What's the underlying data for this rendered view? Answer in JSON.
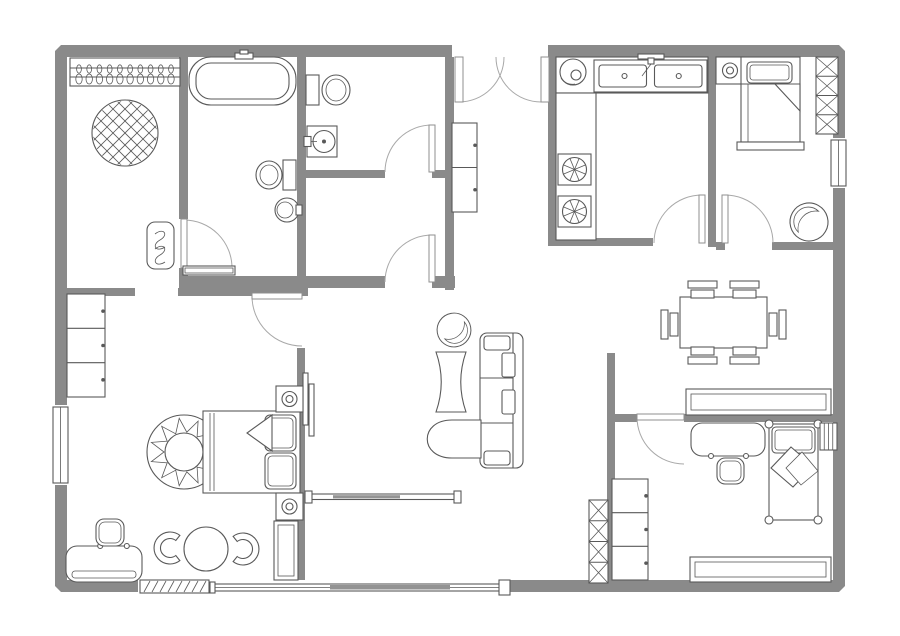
{
  "title": "floor-plan",
  "canvas": {
    "w": 900,
    "h": 636,
    "bg": "#ffffff"
  },
  "palette": {
    "wall": "#8a8a8a",
    "line": "#595959",
    "door_arc": "#a8a8a8"
  },
  "outer_wall": {
    "x": 55,
    "y": 45,
    "w": 790,
    "h": 547,
    "t": 12
  },
  "wall_openings": [
    [
      452,
      44,
      96,
      14
    ],
    [
      830,
      138,
      17,
      50
    ],
    [
      52,
      405,
      17,
      80
    ],
    [
      138,
      578,
      73,
      16
    ],
    [
      210,
      578,
      298,
      16
    ]
  ],
  "walls": [
    [
      179,
      57,
      9,
      162
    ],
    [
      179,
      268,
      9,
      20
    ],
    [
      297,
      57,
      9,
      219
    ],
    [
      445,
      57,
      9,
      233
    ],
    [
      306,
      170,
      79,
      8
    ],
    [
      432,
      170,
      13,
      8
    ],
    [
      179,
      276,
      206,
      12
    ],
    [
      432,
      276,
      23,
      12
    ],
    [
      60,
      288,
      75,
      8
    ],
    [
      178,
      288,
      130,
      8
    ],
    [
      297,
      348,
      8,
      232
    ],
    [
      548,
      57,
      8,
      189
    ],
    [
      548,
      238,
      105,
      8
    ],
    [
      708,
      57,
      8,
      190
    ],
    [
      716,
      242,
      9,
      8
    ],
    [
      772,
      242,
      61,
      8
    ],
    [
      607,
      353,
      8,
      227
    ],
    [
      610,
      414,
      27,
      8
    ],
    [
      684,
      414,
      149,
      8
    ]
  ],
  "windows": [
    {
      "name": "window-bedroom-right",
      "type": "win",
      "x": 831,
      "y": 140,
      "w": 15,
      "h": 46
    },
    {
      "name": "window-bedroom-left",
      "type": "win",
      "x": 53,
      "y": 407,
      "w": 15,
      "h": 76
    },
    {
      "name": "window-louver-bottom",
      "type": "win_hatch",
      "x": 140,
      "y": 580,
      "w": 69,
      "h": 13
    },
    {
      "name": "sliding-patio-door",
      "type": "slider",
      "x1": 212,
      "x2": 506
    },
    {
      "name": "sliding-room-divider",
      "type": "slider2",
      "x1": 308,
      "x2": 457
    }
  ],
  "doors": [
    {
      "name": "entry-double-door",
      "leaves": [
        [
          455,
          57,
          8,
          45
        ],
        [
          541,
          57,
          8,
          45
        ]
      ],
      "arcs": [
        "M459,102 A45,45 0 0 0 504,57",
        "M541,102 A45,45 0 0 1 496,57"
      ]
    },
    {
      "name": "closet-bath-door",
      "leaves": [
        [
          181,
          219,
          6,
          49
        ]
      ],
      "arcs": [
        "M184,220 A48,48 0 0 1 232,268"
      ]
    },
    {
      "name": "bathroom2-door",
      "leaves": [
        [
          429,
          125,
          6,
          47
        ]
      ],
      "arcs": [
        "M432,125 A47,47 0 0 0 385,172"
      ]
    },
    {
      "name": "storage-room-door",
      "leaves": [
        [
          429,
          235,
          6,
          47
        ]
      ],
      "arcs": [
        "M432,235 A47,47 0 0 0 385,282"
      ]
    },
    {
      "name": "bedroom1-door",
      "leaves": [
        [
          252,
          293,
          50,
          6
        ]
      ],
      "arcs": [
        "M252,296 A50,50 0 0 0 302,346"
      ]
    },
    {
      "name": "kitchen-door",
      "leaves": [
        [
          699,
          195,
          6,
          48
        ]
      ],
      "arcs": [
        "M702,195 A48,48 0 0 0 654,243"
      ]
    },
    {
      "name": "bedroom2-door",
      "leaves": [
        [
          722,
          195,
          6,
          48
        ]
      ],
      "arcs": [
        "M725,195 A48,48 0 0 1 773,243"
      ]
    },
    {
      "name": "bedroom3-door",
      "leaves": [
        [
          637,
          414,
          47,
          6
        ]
      ],
      "arcs": [
        "M637,417 A47,47 0 0 0 684,464"
      ]
    }
  ],
  "furniture": [
    {
      "name": "closet-hanger-rail",
      "type": "hanger_rail",
      "x": 70,
      "y": 58,
      "w": 110,
      "h": 28,
      "n": 10
    },
    {
      "name": "closet-round-rug",
      "type": "rug_hatch",
      "cx": 125,
      "cy": 133,
      "r": 33
    },
    {
      "name": "closet-door-mat",
      "type": "rug_squiggle",
      "x": 147,
      "y": 222,
      "w": 27,
      "h": 47
    },
    {
      "name": "bath1-bathtub",
      "type": "bathtub",
      "x": 189,
      "y": 57,
      "w": 107,
      "h": 48
    },
    {
      "name": "bath1-toilet",
      "type": "toilet",
      "tank": [
        283,
        160,
        13,
        30
      ],
      "bowl": [
        269,
        175,
        13,
        14
      ]
    },
    {
      "name": "bath1-basin",
      "type": "sink_round",
      "cx": 287,
      "cy": 210,
      "r": 12
    },
    {
      "name": "bath1-shelf",
      "type": "shelf",
      "x": 183,
      "y": 266,
      "w": 52,
      "h": 9,
      "inset": 2
    },
    {
      "name": "bath2-toilet",
      "type": "toilet",
      "tank": [
        306,
        75,
        13,
        30
      ],
      "bowl": [
        336,
        90,
        14,
        15
      ]
    },
    {
      "name": "bath2-basin",
      "type": "sink_square",
      "x": 307,
      "y": 126,
      "w": 30,
      "h": 31
    },
    {
      "name": "hall-cabinet",
      "type": "cabinet",
      "x": 452,
      "y": 123,
      "w": 25,
      "h": 89,
      "sections": 2
    },
    {
      "name": "kitchen-counter-top",
      "type": "rect",
      "x": 556,
      "y": 57,
      "w": 152,
      "h": 36
    },
    {
      "name": "kitchen-counter-side",
      "type": "rect",
      "x": 556,
      "y": 93,
      "w": 40,
      "h": 147
    },
    {
      "name": "kitchen-double-sink",
      "type": "ksink2",
      "x": 594,
      "y": 60,
      "w": 113,
      "h": 32
    },
    {
      "name": "kitchen-round-sink",
      "type": "ksink_round",
      "cx": 573,
      "cy": 72,
      "r": 13
    },
    {
      "name": "kitchen-burner-1",
      "type": "burner",
      "x": 558,
      "y": 154,
      "w": 33,
      "h": 31
    },
    {
      "name": "kitchen-burner-2",
      "type": "burner",
      "x": 558,
      "y": 196,
      "w": 33,
      "h": 31
    },
    {
      "name": "bedroom2-nightstand",
      "type": "nightstand",
      "x": 716,
      "y": 57,
      "w": 28,
      "h": 27
    },
    {
      "name": "bedroom2-bed",
      "type": "bed_v",
      "x": 741,
      "y": 57,
      "w": 59,
      "h": 85
    },
    {
      "name": "bedroom2-closet-shelves",
      "type": "xshelf",
      "x": 816,
      "y": 57,
      "w": 22,
      "h": 77,
      "cells": 4
    },
    {
      "name": "bedroom2-armchair",
      "type": "tub_chair",
      "cx": 809,
      "cy": 222,
      "r": 19,
      "rot": -15
    },
    {
      "name": "dining-table",
      "type": "rect",
      "x": 680,
      "y": 297,
      "w": 87,
      "h": 51
    },
    {
      "name": "dining-chair-1",
      "type": "chair",
      "x": 688,
      "y": 281,
      "w": 29,
      "h": 17,
      "back": "top"
    },
    {
      "name": "dining-chair-2",
      "type": "chair",
      "x": 730,
      "y": 281,
      "w": 29,
      "h": 17,
      "back": "top"
    },
    {
      "name": "dining-chair-3",
      "type": "chair",
      "x": 688,
      "y": 347,
      "w": 29,
      "h": 17,
      "back": "bottom"
    },
    {
      "name": "dining-chair-4",
      "type": "chair",
      "x": 730,
      "y": 347,
      "w": 29,
      "h": 17,
      "back": "bottom"
    },
    {
      "name": "dining-chair-5",
      "type": "chair",
      "x": 661,
      "y": 310,
      "w": 18,
      "h": 29,
      "back": "left"
    },
    {
      "name": "dining-chair-6",
      "type": "chair",
      "x": 768,
      "y": 310,
      "w": 18,
      "h": 29,
      "back": "right"
    },
    {
      "name": "dining-sideboard",
      "type": "shelf",
      "x": 686,
      "y": 389,
      "w": 145,
      "h": 26,
      "inset": 5
    },
    {
      "name": "living-armchair-round",
      "type": "tub_chair",
      "cx": 454,
      "cy": 330,
      "r": 17,
      "rot": 170
    },
    {
      "name": "living-side-table",
      "type": "hourglass",
      "x": 436,
      "y": 352,
      "w": 30,
      "h": 60
    },
    {
      "name": "living-sofa",
      "type": "sofa",
      "x": 480,
      "y": 333,
      "w": 43,
      "h": 135
    },
    {
      "name": "living-armchair",
      "type": "armchair_d",
      "x": 428,
      "y": 420
    },
    {
      "name": "living-wall-tv",
      "type": "tv",
      "x": 303,
      "y": 373
    },
    {
      "name": "living-shelf-unit",
      "type": "xshelf",
      "x": 589,
      "y": 500,
      "w": 19,
      "h": 83,
      "cells": 4
    },
    {
      "name": "bedroom1-dresser",
      "type": "cabinet",
      "x": 67,
      "y": 294,
      "w": 38,
      "h": 103,
      "sections": 3
    },
    {
      "name": "bedroom1-rug",
      "type": "rug_sun",
      "cx": 184,
      "cy": 452,
      "r": 37
    },
    {
      "name": "bedroom1-bed",
      "type": "bed_h",
      "x": 203,
      "y": 411,
      "w": 97,
      "h": 82
    },
    {
      "name": "bedroom1-nightstand-1",
      "type": "nightstand",
      "x": 276,
      "y": 386,
      "w": 27,
      "h": 26
    },
    {
      "name": "bedroom1-nightstand-2",
      "type": "nightstand",
      "x": 276,
      "y": 493,
      "w": 27,
      "h": 27
    },
    {
      "name": "bedroom1-wardrobe",
      "type": "shelf",
      "x": 274,
      "y": 521,
      "w": 24,
      "h": 59,
      "inset": 4
    },
    {
      "name": "bedroom1-settee",
      "type": "settee",
      "x": 66,
      "y": 546,
      "w": 76,
      "h": 36
    },
    {
      "name": "bedroom1-ottoman",
      "type": "stool",
      "x": 96,
      "y": 519,
      "w": 28,
      "h": 27
    },
    {
      "name": "bedroom1-table",
      "type": "table_round",
      "cx": 206,
      "cy": 549,
      "r": 22
    },
    {
      "name": "bedroom1-chair-1",
      "type": "horseshoe",
      "cx": 170,
      "cy": 548,
      "rot": 0
    },
    {
      "name": "bedroom1-chair-2",
      "type": "horseshoe",
      "cx": 243,
      "cy": 549,
      "rot": 180
    },
    {
      "name": "bedroom3-desk",
      "type": "desk",
      "x": 691,
      "y": 423,
      "w": 74,
      "h": 33
    },
    {
      "name": "bedroom3-stool",
      "type": "stool",
      "x": 717,
      "y": 458,
      "w": 27,
      "h": 26
    },
    {
      "name": "bedroom3-bed",
      "type": "bed_posts",
      "x": 769,
      "y": 424,
      "w": 49,
      "h": 96
    },
    {
      "name": "bedroom3-rack",
      "type": "radiator",
      "x": 820,
      "y": 423,
      "w": 17,
      "h": 27
    },
    {
      "name": "bedroom3-dresser",
      "type": "cabinet",
      "x": 612,
      "y": 479,
      "w": 36,
      "h": 101,
      "sections": 3
    },
    {
      "name": "bedroom3-shelf",
      "type": "shelf",
      "x": 690,
      "y": 557,
      "w": 141,
      "h": 25,
      "inset": 5
    }
  ]
}
